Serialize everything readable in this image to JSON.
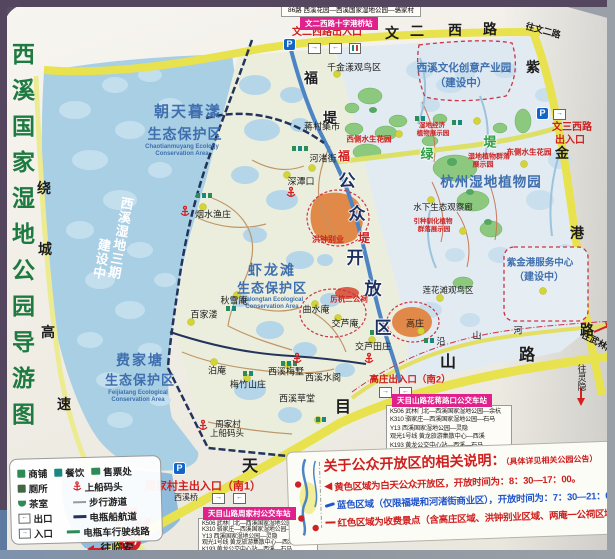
{
  "title": "西溪国家湿地公园导游图",
  "colors": {
    "frame_purple": "#54465f",
    "road_yellow": "#e7e24d",
    "water_blue": "#a9cfe4",
    "causeway_blue": "#4d84c4",
    "accent_red": "#cf1f1f",
    "station_pink": "#e0218c",
    "zone_blue": "#3f6fae",
    "title_green": "#1d7a40"
  },
  "roads": {
    "raocheng": "绕城高速",
    "wenerxilu": "文二西路",
    "zijingang": "紫金港路",
    "tianmushan": "天目山路",
    "yanshanhe": "沿山河",
    "fudi": "福堤",
    "fudi_red": "福堤",
    "lvdi": "绿堤",
    "kaifangqu": "公众开放区"
  },
  "directions": {
    "wen_er": "往文二路",
    "wulinmen": "往武林门",
    "lingyin": "往灵隐",
    "linan": "往临安"
  },
  "entrances": {
    "wenerxilu": "文二西路出入口",
    "wensanxilu_1": "文三西路",
    "wensanxilu_2": "出入口",
    "gaozhuang": "高庄出入口（南2）",
    "zhoujiacun": "周家村主出入口（南1）",
    "liuxia_1": "绕城",
    "liuxia_2": "留下出口"
  },
  "stations": {
    "bus86": "86路 西溪花园—西溪国家湿地公园—骆家村",
    "shizigangqiao": "文二西路十字港桥站",
    "huajiang": "天目山路花蒋路口公交车站",
    "zhoujiacun": "天目山路周家村公交车站",
    "routes": [
      "K506 武林门北—西溪国家湿地公园—余杭",
      "K310 骆家庄—西溪国家湿地公园—石马",
      "Y13 西溪国家湿地公园—灵隐",
      "观光1号线 黄龙旅游集散中心—西溪",
      "K193 黄龙公交中心站—西溪—石马"
    ]
  },
  "zones": {
    "chaotianmuyang": {
      "name1": "朝天暮漾",
      "name2": "生态保护区",
      "en1": "Chaotianmuyang Ecology",
      "en2": "Conservation Area"
    },
    "xialongtan": {
      "name1": "虾龙滩",
      "name2": "生态保护区",
      "en1": "Xialongtan Ecological",
      "en2": "Conservation Area"
    },
    "feijiatang": {
      "name1": "费家塘",
      "name2": "生态保护区",
      "en1": "Feijiatang Ecological",
      "en2": "Conservation Area"
    },
    "phase3_1": "西溪湿地三期",
    "phase3_2": "建设中",
    "chanyeyuan_1": "西溪文化创意产业园",
    "chanyeyuan_2": "（建设中）",
    "zhiwuyuan": "杭州湿地植物园",
    "fuwu_1": "紫金港服务中心",
    "fuwu_2": "（建设中）"
  },
  "spots": {
    "qianjinyang": "千金漾观鸟区",
    "jiangcunjishi": "蒋村集市",
    "yanshuiyuzhuang": "烟水渔庄",
    "shentankou": "深潭口",
    "hezhujie": "河渚街",
    "qiuxuean": "秋雪庵",
    "baijialou": "百家溇",
    "boan": "泊庵",
    "meizhushanzhuang": "梅竹山庄",
    "xiximeishu": "西溪梅墅",
    "xixishuige": "西溪水阁",
    "xixicaotang": "西溪草堂",
    "qushuian": "曲水庵",
    "jiaoluan": "交芦庵",
    "jiaolutianzhuang": "交芦田庄",
    "gaozhuang": "高庄",
    "lianhuatan": "莲花滩观鸟区",
    "shuixia": "水下生态观察廊",
    "zhoujiacun": "周家村",
    "shangchuanmatou": "上船码头",
    "xixiqiao": "西溪桥",
    "hongzhongbieye": "洪钟别业",
    "lihangergongci": "厉杭二公祠",
    "xice": "西侧水生花园",
    "dongce": "东侧水生花园",
    "shidiqunluo_1": "湿地植物群落",
    "shidiqunluo_2": "展示园",
    "shidijingji_1": "湿地经济",
    "shidijingji_2": "植物展示园",
    "yinzhong_1": "引种驯化植物",
    "yinzhong_2": "群落展示园"
  },
  "legend": {
    "shops": "商铺",
    "dining": "餐饮",
    "ticket": "售票处",
    "toilet": "厕所",
    "dock": "上船码头",
    "tea": "茶室",
    "trail": "步行游道",
    "exit": "出口",
    "boat": "电瓶船航道",
    "entry": "入口",
    "cart": "电瓶车行驶线路"
  },
  "notice": {
    "title": "关于公众开放区的相关说明：",
    "subtitle": "（具体详见相关公园公告）",
    "line1": "黄色区域为白天公众开放区，开放时间为：8：30—17：00。",
    "line2": "蓝色区域（仅限福堤和河渚街商业区），开放时间为：7：30—21：00",
    "line3": "红色区域为收费景点（含高庄区域、洪钟别业区域、两庵一公祠区域）。"
  },
  "icons": {
    "parking": "P",
    "arrow_in": "→",
    "arrow_out": "←"
  }
}
